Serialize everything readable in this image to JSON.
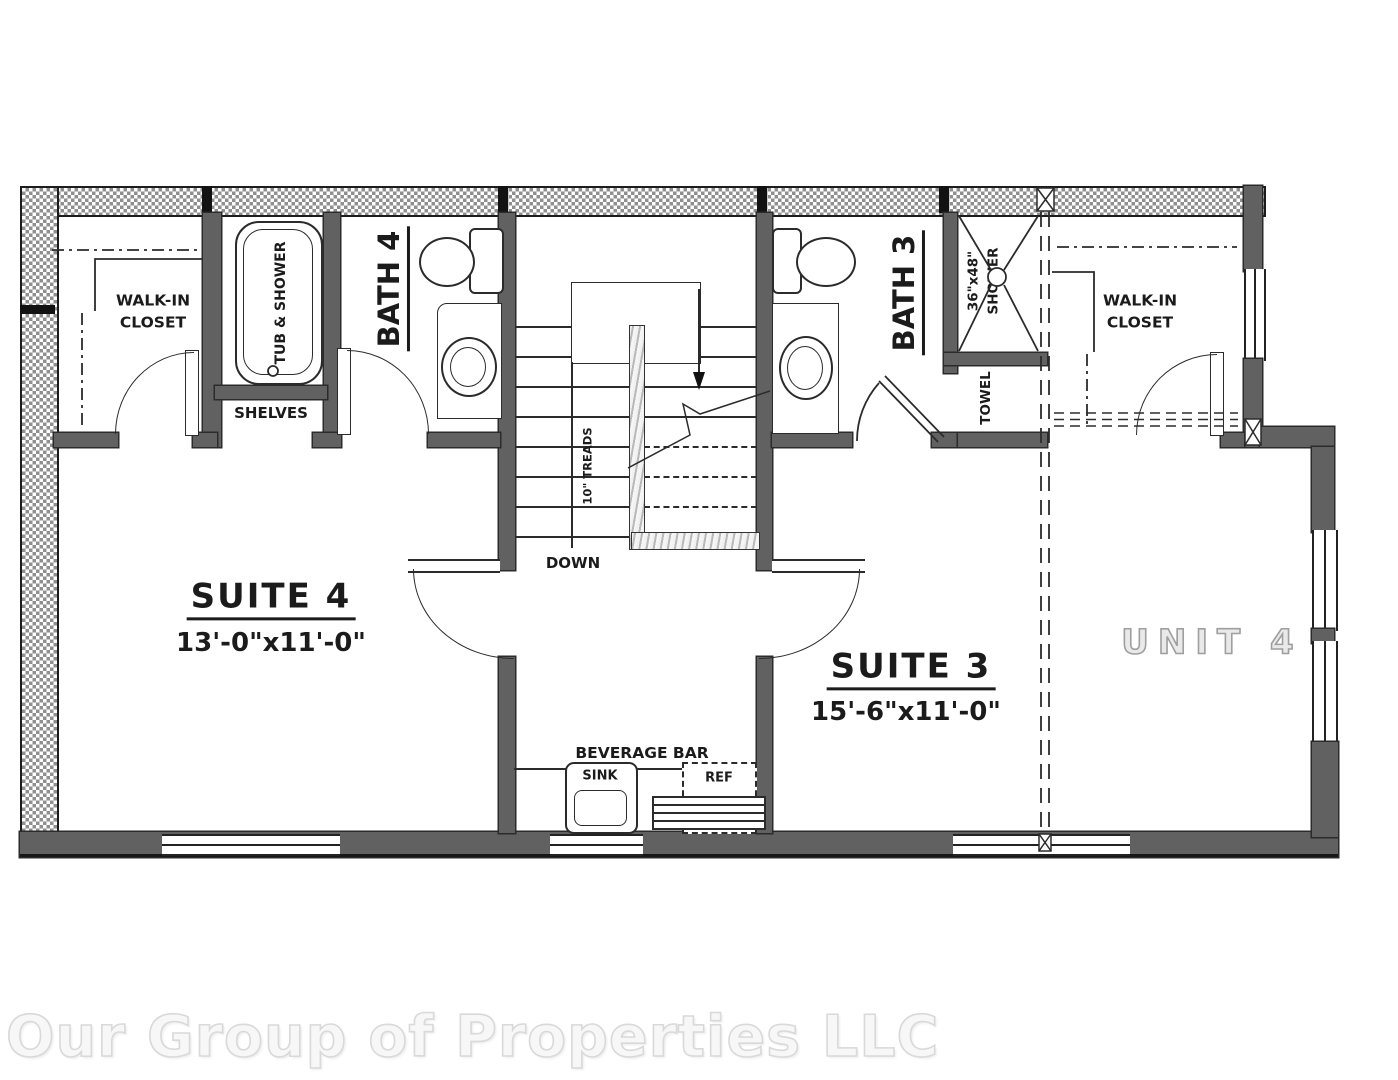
{
  "plan": {
    "watermark": "Our Group of Properties LLC",
    "labels": {
      "suite4_name": "SUITE 4",
      "suite4_dims": "13'-0\"x11'-0\"",
      "suite3_name": "SUITE 3",
      "suite3_dims": "15'-6\"x11'-0\"",
      "unit4": "UNIT 4",
      "walkin_line1": "WALK-IN",
      "walkin_line2": "CLOSET",
      "bath4": "BATH 4",
      "bath3": "BATH 3",
      "tub_shower": "TUB & SHOWER",
      "shelves": "SHELVES",
      "shower_size": "36\"x48\"",
      "shower_word": "SHOWER",
      "towel": "TOWEL",
      "down": "DOWN",
      "treads": "10\" TREADS",
      "beverage_bar": "BEVERAGE BAR",
      "sink": "SINK",
      "ref": "REF"
    },
    "colors": {
      "wall": "#616161",
      "hatch": "#8f8f8f",
      "line": "#2b2b2b",
      "unit4_text": "#9f9f9f",
      "watermark": "#d9d9d9"
    }
  }
}
